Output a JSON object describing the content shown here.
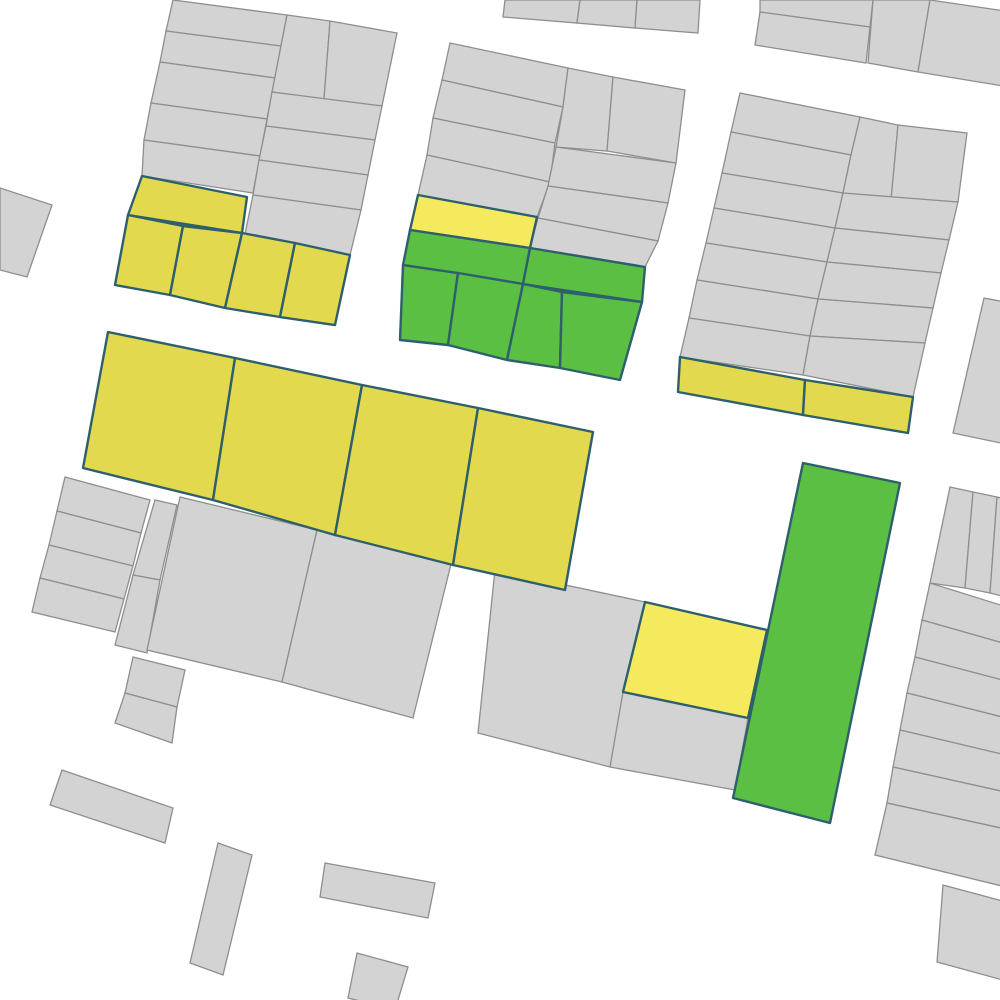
{
  "map": {
    "canvas": {
      "width": 1000,
      "height": 1000,
      "background": "#ffffff"
    },
    "palette": {
      "gray": {
        "fill": "#d3d3d3",
        "stroke": "#8e8e8e"
      },
      "yellow": {
        "fill": "#e3d94e",
        "stroke": "#2e5f6d"
      },
      "light_yellow": {
        "fill": "#f5ea5e",
        "stroke": "#2e5f6d"
      },
      "green": {
        "fill": "#5abf43",
        "stroke": "#2e5f6d"
      }
    },
    "parcels": [
      {
        "fill": "gray",
        "pts": "173,0 287,15 281,46 166,31"
      },
      {
        "fill": "gray",
        "pts": "166,31 281,46 275,78 160,62"
      },
      {
        "fill": "gray",
        "pts": "160,62 275,78 267,119 151,103"
      },
      {
        "fill": "gray",
        "pts": "151,103 267,119 260,156 144,140"
      },
      {
        "fill": "gray",
        "pts": "144,140 260,156 253,193 142,176"
      },
      {
        "fill": "gray",
        "pts": "287,15 330,21 324,99 272,92"
      },
      {
        "fill": "gray",
        "pts": "330,21 397,33 382,106 324,99"
      },
      {
        "fill": "gray",
        "pts": "272,92 382,106 375,140 266,126"
      },
      {
        "fill": "gray",
        "pts": "266,126 375,140 368,175 259,160"
      },
      {
        "fill": "gray",
        "pts": "259,160 368,175 361,210 253,195"
      },
      {
        "fill": "gray",
        "pts": "253,195 361,210 350,255 245,234"
      },
      {
        "fill": "yellow",
        "pts": "142,176 247,197 242,233 128,215"
      },
      {
        "fill": "yellow",
        "pts": "128,215 183,226 170,295 115,285"
      },
      {
        "fill": "yellow",
        "pts": "183,226 242,233 225,308 170,295"
      },
      {
        "fill": "yellow",
        "pts": "242,233 295,243 280,317 225,308"
      },
      {
        "fill": "yellow",
        "pts": "295,243 350,255 335,325 280,317"
      },
      {
        "fill": "gray",
        "pts": "505,0 580,0 577,23 503,17"
      },
      {
        "fill": "gray",
        "pts": "580,0 637,0 635,28 577,23"
      },
      {
        "fill": "gray",
        "pts": "637,0 700,0 698,33 635,28"
      },
      {
        "fill": "gray",
        "pts": "760,0 873,0 870,27 760,12"
      },
      {
        "fill": "gray",
        "pts": "760,12 870,27 866,63 755,45"
      },
      {
        "fill": "gray",
        "pts": "873,0 930,0 918,72 868,63"
      },
      {
        "fill": "gray",
        "pts": "930,0 1005,11 1003,86 918,72"
      },
      {
        "fill": "gray",
        "pts": "450,43 568,68 563,107 442,80"
      },
      {
        "fill": "gray",
        "pts": "442,80 563,107 555,143 433,118"
      },
      {
        "fill": "gray",
        "pts": "433,118 555,143 550,182 427,155"
      },
      {
        "fill": "gray",
        "pts": "427,155 550,182 537,217 418,195"
      },
      {
        "fill": "gray",
        "pts": "568,68 613,77 607,151 556,147 563,107"
      },
      {
        "fill": "gray",
        "pts": "613,77 685,90 676,163 607,151"
      },
      {
        "fill": "gray",
        "pts": "556,147 676,163 668,203 548,186"
      },
      {
        "fill": "gray",
        "pts": "548,186 668,203 658,241 538,218"
      },
      {
        "fill": "gray",
        "pts": "538,218 658,241 645,267 530,248"
      },
      {
        "fill": "light_yellow",
        "pts": "418,195 537,217 530,248 410,230"
      },
      {
        "fill": "green",
        "pts": "410,230 530,248 523,284 403,265"
      },
      {
        "fill": "green",
        "pts": "530,248 645,267 642,302 523,284"
      },
      {
        "fill": "green",
        "pts": "403,265 458,273 448,345 400,340"
      },
      {
        "fill": "green",
        "pts": "458,273 523,284 507,360 448,345"
      },
      {
        "fill": "green",
        "pts": "523,284 562,292 560,368 507,360"
      },
      {
        "fill": "green",
        "pts": "562,292 642,302 620,380 560,368"
      },
      {
        "fill": "gray",
        "pts": "740,93 860,117 851,155 731,132"
      },
      {
        "fill": "gray",
        "pts": "731,132 851,155 843,193 722,173"
      },
      {
        "fill": "gray",
        "pts": "722,173 843,193 835,228 714,208"
      },
      {
        "fill": "gray",
        "pts": "714,208 835,228 827,262 706,243"
      },
      {
        "fill": "gray",
        "pts": "706,243 827,262 818,299 697,280"
      },
      {
        "fill": "gray",
        "pts": "697,280 818,299 810,336 689,318"
      },
      {
        "fill": "gray",
        "pts": "689,318 810,336 803,375 680,357"
      },
      {
        "fill": "gray",
        "pts": "860,117 898,125 891,200 843,193 851,155"
      },
      {
        "fill": "gray",
        "pts": "898,125 967,133 958,202 891,200"
      },
      {
        "fill": "gray",
        "pts": "843,193 958,202 949,240 835,228"
      },
      {
        "fill": "gray",
        "pts": "835,228 949,240 941,273 827,262"
      },
      {
        "fill": "gray",
        "pts": "827,262 941,273 933,308 818,299"
      },
      {
        "fill": "gray",
        "pts": "818,299 933,308 925,343 810,336"
      },
      {
        "fill": "gray",
        "pts": "810,336 925,343 913,397 803,375"
      },
      {
        "fill": "yellow",
        "pts": "680,357 805,380 803,415 678,392"
      },
      {
        "fill": "yellow",
        "pts": "805,380 913,397 908,433 803,415"
      },
      {
        "fill": "yellow",
        "pts": "108,332 235,358 213,500 83,468"
      },
      {
        "fill": "yellow",
        "pts": "235,358 362,385 335,535 213,500"
      },
      {
        "fill": "yellow",
        "pts": "362,385 478,408 453,565 335,535"
      },
      {
        "fill": "yellow",
        "pts": "478,408 593,432 565,590 453,565"
      },
      {
        "fill": "gray",
        "pts": "0,188 52,205 27,277 0,270"
      },
      {
        "fill": "gray",
        "pts": "65,477 150,500 141,533 57,511"
      },
      {
        "fill": "gray",
        "pts": "57,511 141,533 133,566 49,545"
      },
      {
        "fill": "gray",
        "pts": "49,545 133,566 124,599 40,578"
      },
      {
        "fill": "gray",
        "pts": "40,578 124,599 115,632 32,612"
      },
      {
        "fill": "gray",
        "pts": "155,500 177,505 160,580 133,575"
      },
      {
        "fill": "gray",
        "pts": "133,575 160,580 147,653 115,645"
      },
      {
        "fill": "gray",
        "pts": "180,497 317,530 282,682 147,650"
      },
      {
        "fill": "gray",
        "pts": "317,530 452,560 413,718 282,682"
      },
      {
        "fill": "gray",
        "pts": "133,657 185,670 177,707 125,693"
      },
      {
        "fill": "gray",
        "pts": "125,693 177,707 172,743 115,723"
      },
      {
        "fill": "gray",
        "pts": "495,570 645,602 610,767 478,733"
      },
      {
        "fill": "light_yellow",
        "pts": "645,602 767,630 748,718 623,692"
      },
      {
        "fill": "gray",
        "pts": "623,692 748,718 735,790 610,767"
      },
      {
        "fill": "green",
        "pts": "803,463 900,483 830,823 733,798"
      },
      {
        "fill": "gray",
        "pts": "984,298 1010,303 1010,445 953,433"
      },
      {
        "fill": "gray",
        "pts": "950,487 973,492 965,588 930,583"
      },
      {
        "fill": "gray",
        "pts": "973,492 997,497 990,593 965,588"
      },
      {
        "fill": "gray",
        "pts": "997,497 1010,500 1010,598 990,593"
      },
      {
        "fill": "gray",
        "pts": "930,583 1010,608 1010,645 922,620"
      },
      {
        "fill": "gray",
        "pts": "922,620 1010,645 1010,682 915,657"
      },
      {
        "fill": "gray",
        "pts": "915,657 1010,682 1010,719 907,693"
      },
      {
        "fill": "gray",
        "pts": "907,693 1010,719 1010,756 900,730"
      },
      {
        "fill": "gray",
        "pts": "900,730 1010,756 1010,793 893,767"
      },
      {
        "fill": "gray",
        "pts": "893,767 1010,793 1010,830 887,803"
      },
      {
        "fill": "gray",
        "pts": "887,803 1010,830 1010,888 875,855"
      },
      {
        "fill": "gray",
        "pts": "943,885 1010,903 1010,982 937,962"
      },
      {
        "fill": "gray",
        "pts": "62,770 173,808 165,843 50,805"
      },
      {
        "fill": "gray",
        "pts": "218,843 252,855 223,975 190,963"
      },
      {
        "fill": "gray",
        "pts": "325,863 435,883 428,918 320,897"
      },
      {
        "fill": "gray",
        "pts": "357,953 408,967 395,1010 348,998"
      }
    ]
  }
}
